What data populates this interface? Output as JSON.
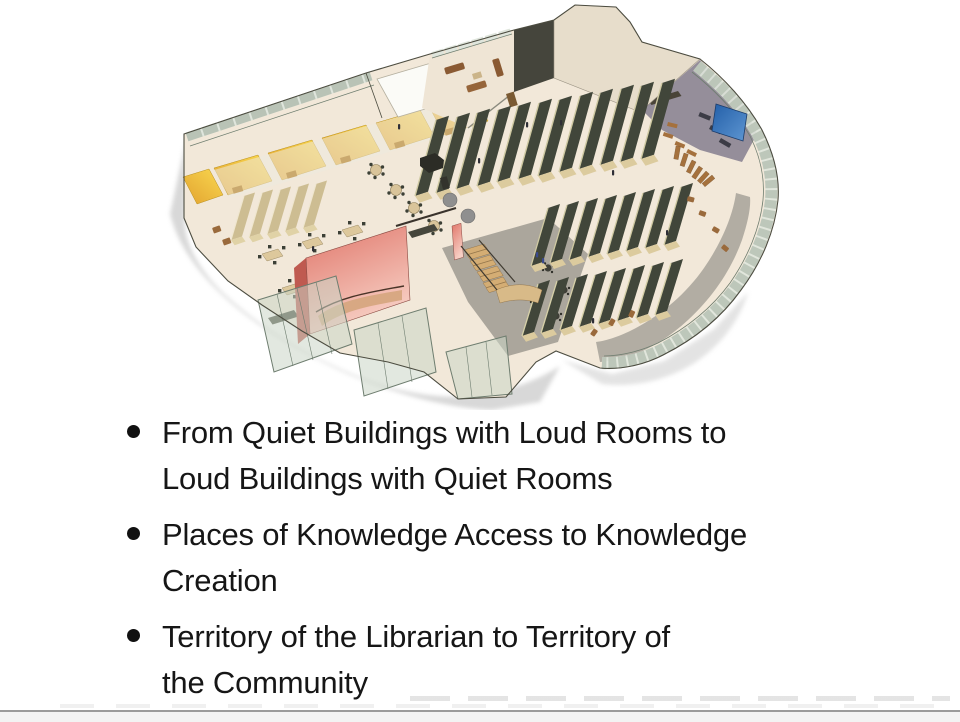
{
  "slide": {
    "bullets": [
      {
        "lines": [
          "From Quiet Buildings with Loud Rooms to",
          "Loud Buildings with Quiet Rooms"
        ]
      },
      {
        "lines": [
          "Places of Knowledge Access to Knowledge",
          "Creation"
        ]
      },
      {
        "lines": [
          "Territory of the Librarian to Territory of",
          "the Community"
        ]
      }
    ],
    "illustration": {
      "name": "library-floor-isometric-cutaway",
      "regions": [
        "yellow-study-rooms",
        "skylight",
        "lounge-with-sofas",
        "book-stacks",
        "red-stair-atrium",
        "wooden-staircase",
        "curved-glass-facade",
        "blue-wall-panel",
        "reading-tables",
        "computer-area"
      ]
    }
  },
  "colors": {
    "background": "#ffffff",
    "text": "#161616",
    "bullet": "#111111",
    "floor": "#f2e8d9",
    "wall_tan": "#e7ddcb",
    "glass": "#dfe5dc",
    "glass_frame": "#6e7d6f",
    "yellow_room_dark": "#e2a22f",
    "yellow_room_light": "#f9d850",
    "atrium_red_dark": "#e0766a",
    "atrium_red_light": "#f7cfc4",
    "accent_blue_dark": "#235fa8",
    "accent_blue_light": "#5e96d2",
    "stacks": "#41463a",
    "stacks_end": "#dccb9e",
    "wood": "#a5713d",
    "stair_wood": "#d4ad74",
    "gray_floor": "#aba69c",
    "shadow": "#c8c8c8",
    "outline": "#4c4c40",
    "bottom_line": "#9b9b9b",
    "bottom_strip": "#f3f3f3"
  }
}
